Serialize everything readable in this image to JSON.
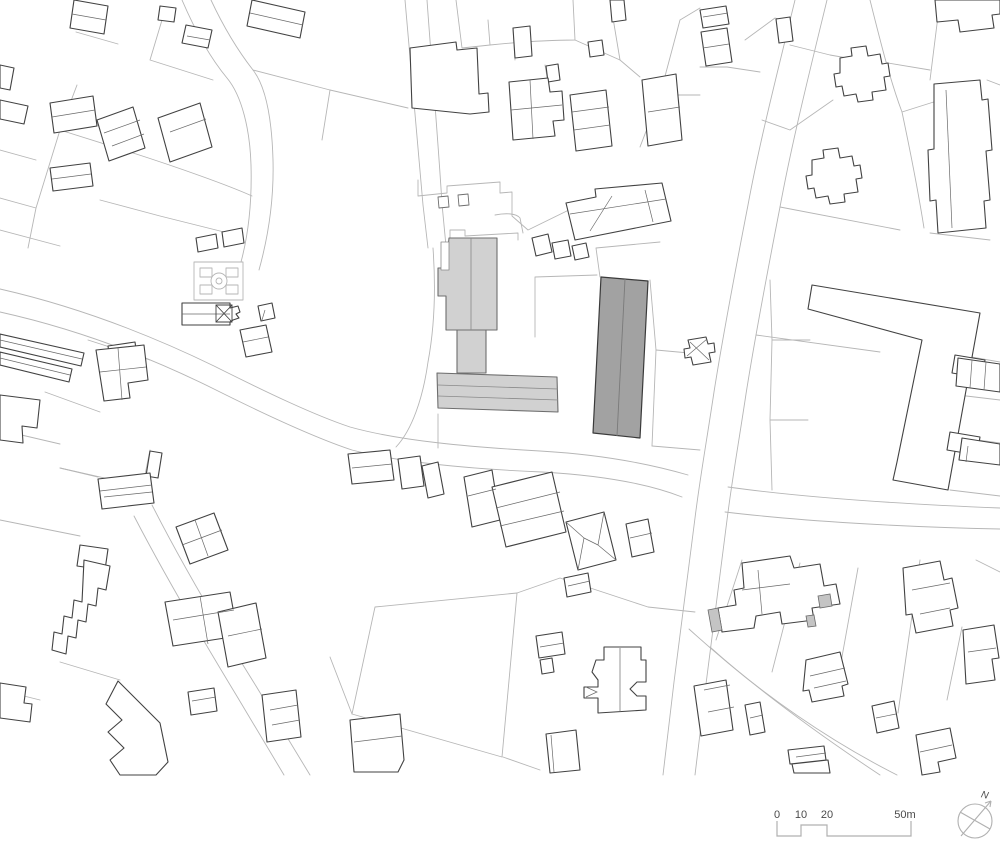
{
  "legend": {
    "scale": {
      "labels": [
        "0",
        "10",
        "20",
        "50m"
      ]
    },
    "north_label": "N"
  },
  "colors": {
    "background": "#ffffff",
    "parcel_line": "#b6b6b6",
    "building_outline": "#424242",
    "building_detail_line": "#6a6a6a",
    "highlight_light_fill": "#d1d1d1",
    "highlight_light_outline": "#6e6e6e",
    "highlight_dark_fill": "#a2a2a2",
    "highlight_dark_outline": "#3a3a3a",
    "legend_line": "#b0b0b0",
    "legend_text": "#4a4a4a"
  }
}
